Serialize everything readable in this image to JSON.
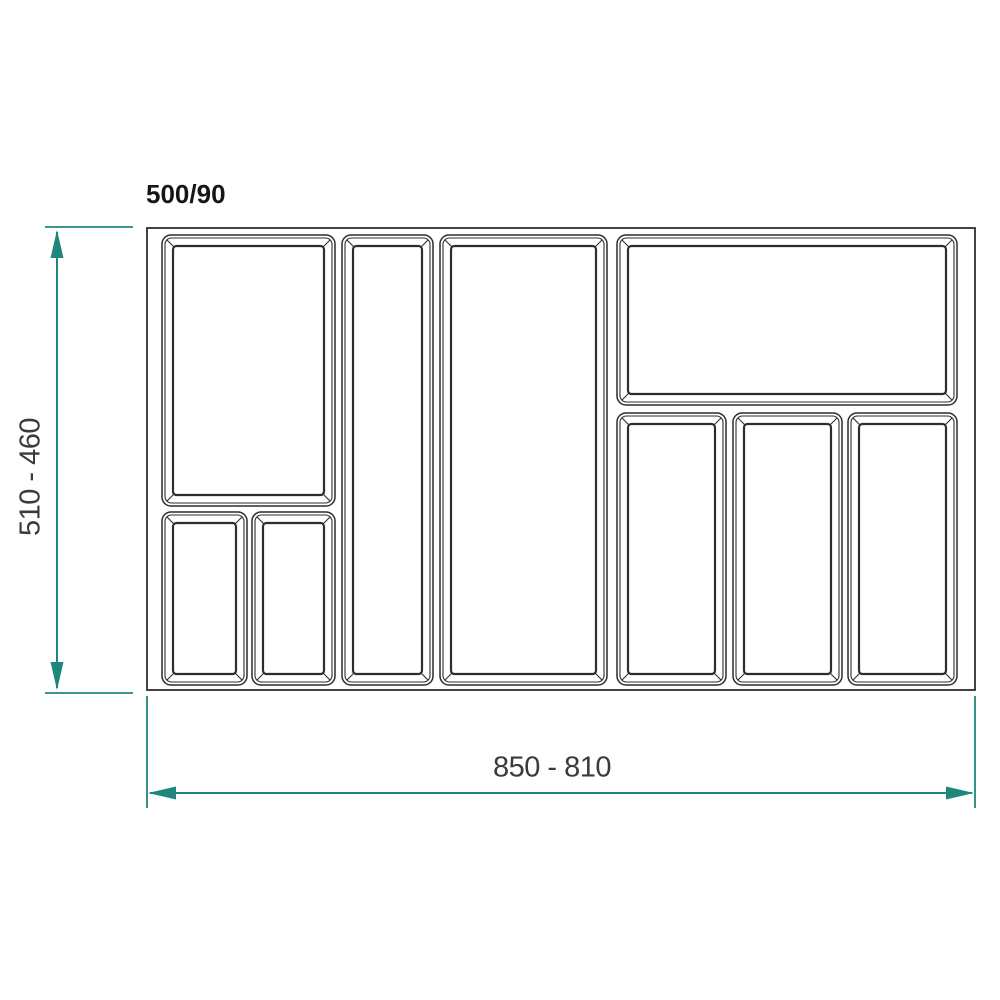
{
  "title": "500/90",
  "dimensions": {
    "vertical": {
      "label": "510 - 460"
    },
    "horizontal": {
      "label": "850 - 810"
    },
    "line_color": "#1F867C",
    "text_color": "#3B3B3B"
  },
  "drawing": {
    "stroke_color": "#2D2D2D",
    "tray_outline": {
      "x": 147,
      "y": 228,
      "w": 828,
      "h": 462
    },
    "compartments": [
      {
        "name": "top-left-tall",
        "x": 162,
        "y": 235,
        "w": 173,
        "h": 271
      },
      {
        "name": "bottom-left-small-1",
        "x": 162,
        "y": 512,
        "w": 85,
        "h": 173
      },
      {
        "name": "bottom-left-small-2",
        "x": 252,
        "y": 512,
        "w": 83,
        "h": 173
      },
      {
        "name": "center-narrow-column",
        "x": 342,
        "y": 235,
        "w": 91,
        "h": 450
      },
      {
        "name": "center-wide-column",
        "x": 440,
        "y": 235,
        "w": 167,
        "h": 450
      },
      {
        "name": "top-right-wide",
        "x": 617,
        "y": 235,
        "w": 340,
        "h": 170
      },
      {
        "name": "right-column-1",
        "x": 617,
        "y": 413,
        "w": 109,
        "h": 272
      },
      {
        "name": "right-column-2",
        "x": 733,
        "y": 413,
        "w": 109,
        "h": 272
      },
      {
        "name": "right-column-3",
        "x": 848,
        "y": 413,
        "w": 109,
        "h": 272
      }
    ]
  }
}
